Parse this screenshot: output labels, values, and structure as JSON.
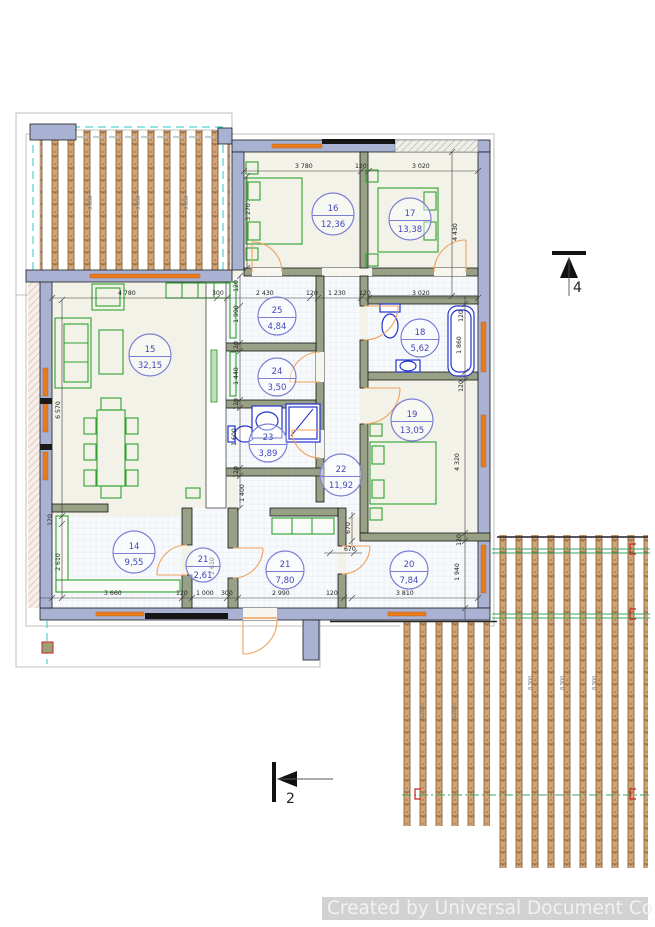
{
  "watermark": {
    "text": "Created by Universal Document Converter"
  },
  "sections": {
    "right": "4",
    "bottom": "2"
  },
  "decks": {
    "top_label": "3 650",
    "short_label": "6 280",
    "long_label": "8 900"
  },
  "rooms": [
    {
      "number": "15",
      "area": "32,15"
    },
    {
      "number": "16",
      "area": "12,36"
    },
    {
      "number": "17",
      "area": "13,38"
    },
    {
      "number": "25",
      "area": "4,84"
    },
    {
      "number": "24",
      "area": "3,50"
    },
    {
      "number": "18",
      "area": "5,62"
    },
    {
      "number": "23",
      "area": "3,89"
    },
    {
      "number": "19",
      "area": "13,05"
    },
    {
      "number": "22",
      "area": "11,92"
    },
    {
      "number": "14",
      "area": "9,55"
    },
    {
      "number": "21",
      "area": "2,61"
    },
    {
      "number": "21",
      "area": "7,80"
    },
    {
      "number": "20",
      "area": "7,84"
    }
  ],
  "dims": [
    "3 780",
    "120",
    "3 020",
    "3 270",
    "4 430",
    "4 780",
    "300",
    "2 430",
    "120",
    "1 230",
    "120",
    "3 020",
    "6 570",
    "120",
    "2 610",
    "120",
    "1 990",
    "120",
    "1 440",
    "120",
    "1 600",
    "120",
    "1 400",
    "120",
    "1 860",
    "120",
    "4 320",
    "120",
    "1 940",
    "670",
    "670",
    "3 660",
    "120",
    "1 000",
    "300",
    "2 990",
    "120",
    "3 810",
    "2 610"
  ],
  "colors": {
    "exterior_wall": "#a9b2d2",
    "interior_wall": "#98a086",
    "furniture": "#2fa12f",
    "plumbing": "#2233cc",
    "door": "#efa25e",
    "window": "#e87b1e",
    "deck_joist": "#d2a572",
    "guide_cyan": "#2fc7c7",
    "room_label": "#4347b8",
    "deck_accent_green": "#3aa558",
    "marker_red": "#cc2222",
    "watermark_bg": "#d2d2d2"
  }
}
